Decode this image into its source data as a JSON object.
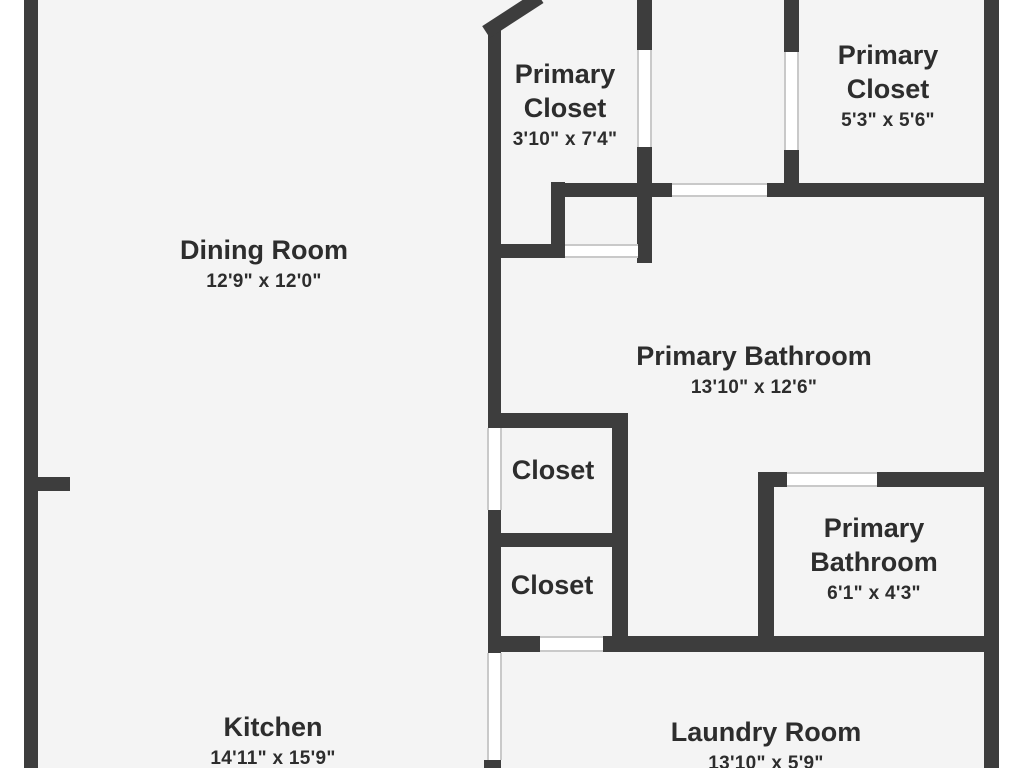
{
  "colors": {
    "wall": "#3d3d3d",
    "floor": "#f4f4f4",
    "background": "#ffffff",
    "opening_line": "#c9c9c9",
    "text": "#2d2d2d"
  },
  "rooms": [
    {
      "name": "Dining Room",
      "dims": "12'9\" x 12'0\""
    },
    {
      "name": "Primary Closet",
      "dims": "3'10\" x 7'4\""
    },
    {
      "name": "Primary Closet",
      "dims": "5'3\" x 5'6\""
    },
    {
      "name": "Primary Bathroom",
      "dims": "13'10\" x 12'6\""
    },
    {
      "name": "Closet"
    },
    {
      "name": "Closet"
    },
    {
      "name": "Primary Bathroom",
      "dims": "6'1\" x 4'3\""
    },
    {
      "name": "Kitchen",
      "dims": "14'11\" x 15'9\""
    },
    {
      "name": "Laundry Room",
      "dims": "13'10\" x 5'9\""
    }
  ]
}
